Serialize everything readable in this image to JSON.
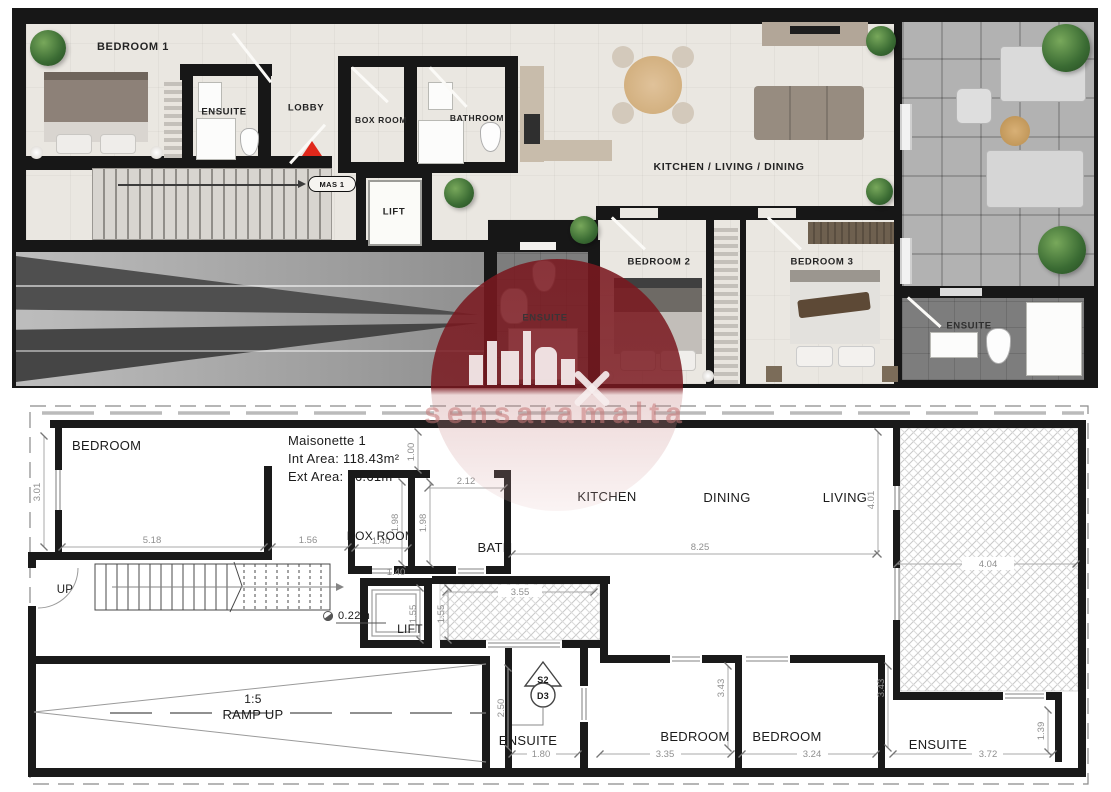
{
  "watermark": {
    "text": "sensaramalta",
    "color": "#7a181f"
  },
  "render_plan": {
    "labels": {
      "bedroom1": "BEDROOM 1",
      "ensuite1": "ENSUITE",
      "lobby": "LOBBY",
      "box_room": "BOX ROOM",
      "bathroom": "BATHROOM",
      "lift": "LIFT",
      "kitchen_living_dining": "KITCHEN / LIVING / DINING",
      "bedroom2": "BEDROOM 2",
      "bedroom3": "BEDROOM 3",
      "ensuite_mid": "ENSUITE",
      "ensuite_right": "ENSUITE",
      "tag": "MAS 1"
    }
  },
  "technical_plan": {
    "info": {
      "title": "Maisonette 1",
      "int_area": "Int Area: 118.43m²",
      "ext_area": "Ext Area: 26.61m²"
    },
    "rooms": {
      "bedroom": "BEDROOM",
      "box_room": "BOX ROOM",
      "bath": "BATH",
      "kitchen": "KITCHEN",
      "dining": "DINING",
      "living": "LIVING",
      "lift": "LIFT",
      "ensuite_mid": "ENSUITE",
      "bedroom_b1": "BEDROOM",
      "bedroom_b2": "BEDROOM",
      "ensuite_right": "ENSUITE"
    },
    "notes": {
      "up": "UP",
      "ramp_ratio": "1:5",
      "ramp_label": "RAMP UP",
      "step": "0.22m",
      "sym_top": "S2",
      "sym_bottom": "D3"
    },
    "dims": {
      "bed_top_h": "3.01",
      "bed_top_w": "5.18",
      "lobby_w": "1.56",
      "seg": "1.00",
      "box_w": "1.40",
      "box_h": "1.98",
      "bath_h": "1.98",
      "bath_w": "2.12",
      "kld_w": "8.25",
      "kld_h": "4.01",
      "terrace_w": "4.04",
      "yard_w": "3.55",
      "yard_h": "1.55",
      "lift_h": "1.55",
      "lift_w": "1.40",
      "ens_mid_h": "2.50",
      "ens_mid_w": "1.80",
      "bed_b1_h": "3.43",
      "bed_b2_h": "3.43",
      "bed_b1_w": "3.35",
      "bed_b2_w": "3.24",
      "ens_r_w": "3.72",
      "ens_r_h": "1.39"
    }
  }
}
